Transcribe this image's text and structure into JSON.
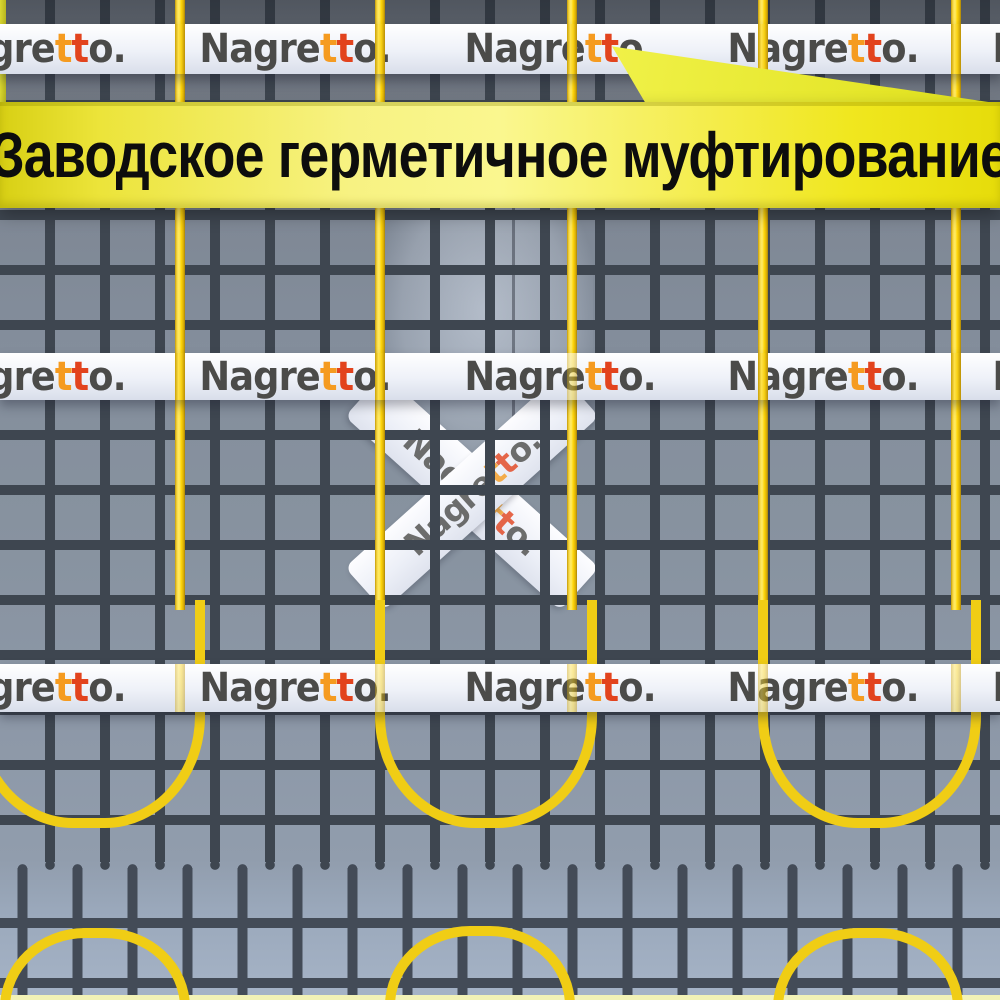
{
  "banner": {
    "text": "Заводское герметичное муфтирование",
    "background_color": "#f2ea2e",
    "text_color": "#0d0d0d"
  },
  "brand": {
    "name": "Nagretto.",
    "prefix": "Nagre",
    "t1": "t",
    "t2": "t",
    "suffix": "o.",
    "gray_color": "#4b4b49",
    "t1_color": "#f59b20",
    "t2_color": "#e2431d"
  },
  "scene": {
    "cable_color": "#ffd60a",
    "mesh_line_color": "#3e4650",
    "concrete_color": "#87929f",
    "tape_color": "#eef1f8",
    "tape_band_count": 3,
    "cable_runs": 5
  }
}
